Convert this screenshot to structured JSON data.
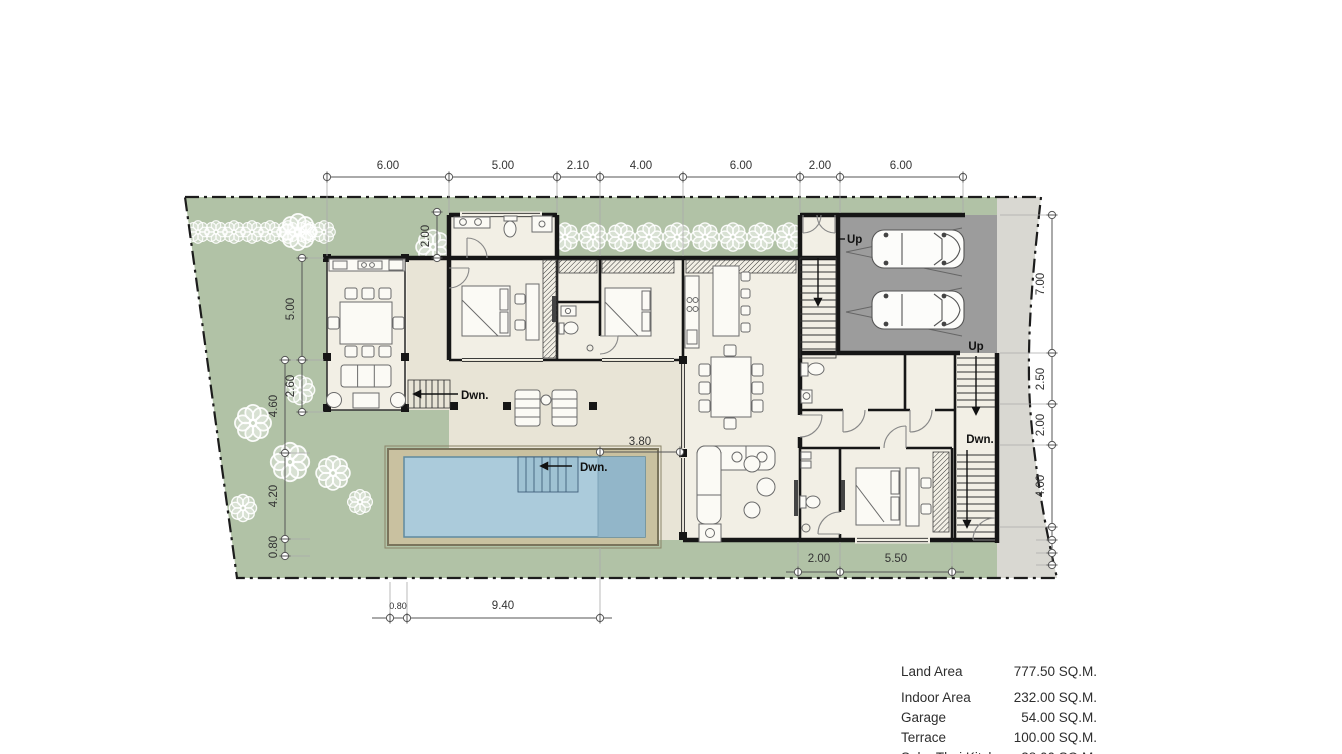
{
  "plan": {
    "labels": {
      "up": "Up",
      "down": "Dwn."
    },
    "dims": {
      "top": [
        "6.00",
        "5.00",
        "2.10",
        "4.00",
        "6.00",
        "2.00",
        "6.00"
      ],
      "left_inner": [
        "5.00",
        "2.60"
      ],
      "left_outer": [
        "4.60",
        "4.20",
        "0.80"
      ],
      "right": [
        "7.00",
        "2.50",
        "2.00",
        "4.00"
      ],
      "upper_small": "2.00",
      "terrace": "3.80",
      "bottom_left": [
        "0.80",
        "9.40"
      ],
      "bottom_mid": [
        "2.00",
        "5.50"
      ]
    },
    "colors": {
      "landscape": "#b1c2a6",
      "driveway": "#d9d8d2",
      "garage": "#9c9c9c",
      "terrace": "#e8e4d6",
      "interior": "#f2efe5",
      "pool_deck": "#c9c1a0",
      "pool_water": "#abcbdb",
      "pool_deep": "#92b6c9",
      "wall": "#1a1a1a"
    }
  },
  "area_table": {
    "rows": [
      {
        "label": "Land Area",
        "value": "777.50 SQ.M."
      },
      {
        "label": "Indoor Area",
        "value": "232.00 SQ.M."
      },
      {
        "label": "Garage",
        "value": "54.00 SQ.M."
      },
      {
        "label": "Terrace",
        "value": "100.00 SQ.M."
      },
      {
        "label": "Sala+Thai Kitchen",
        "value": "38.00 SQ.M."
      }
    ]
  }
}
